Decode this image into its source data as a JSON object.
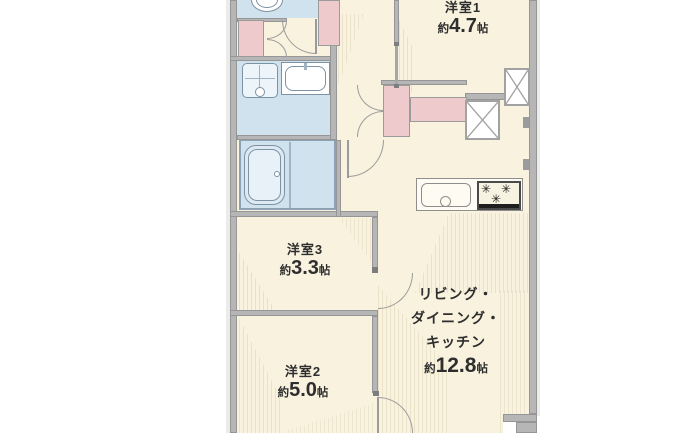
{
  "floor_plan": {
    "rooms": {
      "bedroom1": {
        "name": "洋室1",
        "approx": "約",
        "area": "4.7",
        "unit": "帖"
      },
      "bedroom2": {
        "name": "洋室2",
        "approx": "約",
        "area": "5.0",
        "unit": "帖"
      },
      "bedroom3": {
        "name": "洋室3",
        "approx": "約",
        "area": "3.3",
        "unit": "帖"
      },
      "ldk": {
        "line1": "リビング・",
        "line2": "ダイニング・",
        "line3": "キッチン",
        "approx": "約",
        "area": "12.8",
        "unit": "帖"
      }
    },
    "icons": {
      "stove_burner": "✳"
    },
    "colors": {
      "floor_cream": "#f8f2de",
      "wet_area_blue": "#cfe2ee",
      "fixture_pink": "#efcacd",
      "wall_gray": "#b6b6b6",
      "text": "#2e2e2e"
    }
  }
}
